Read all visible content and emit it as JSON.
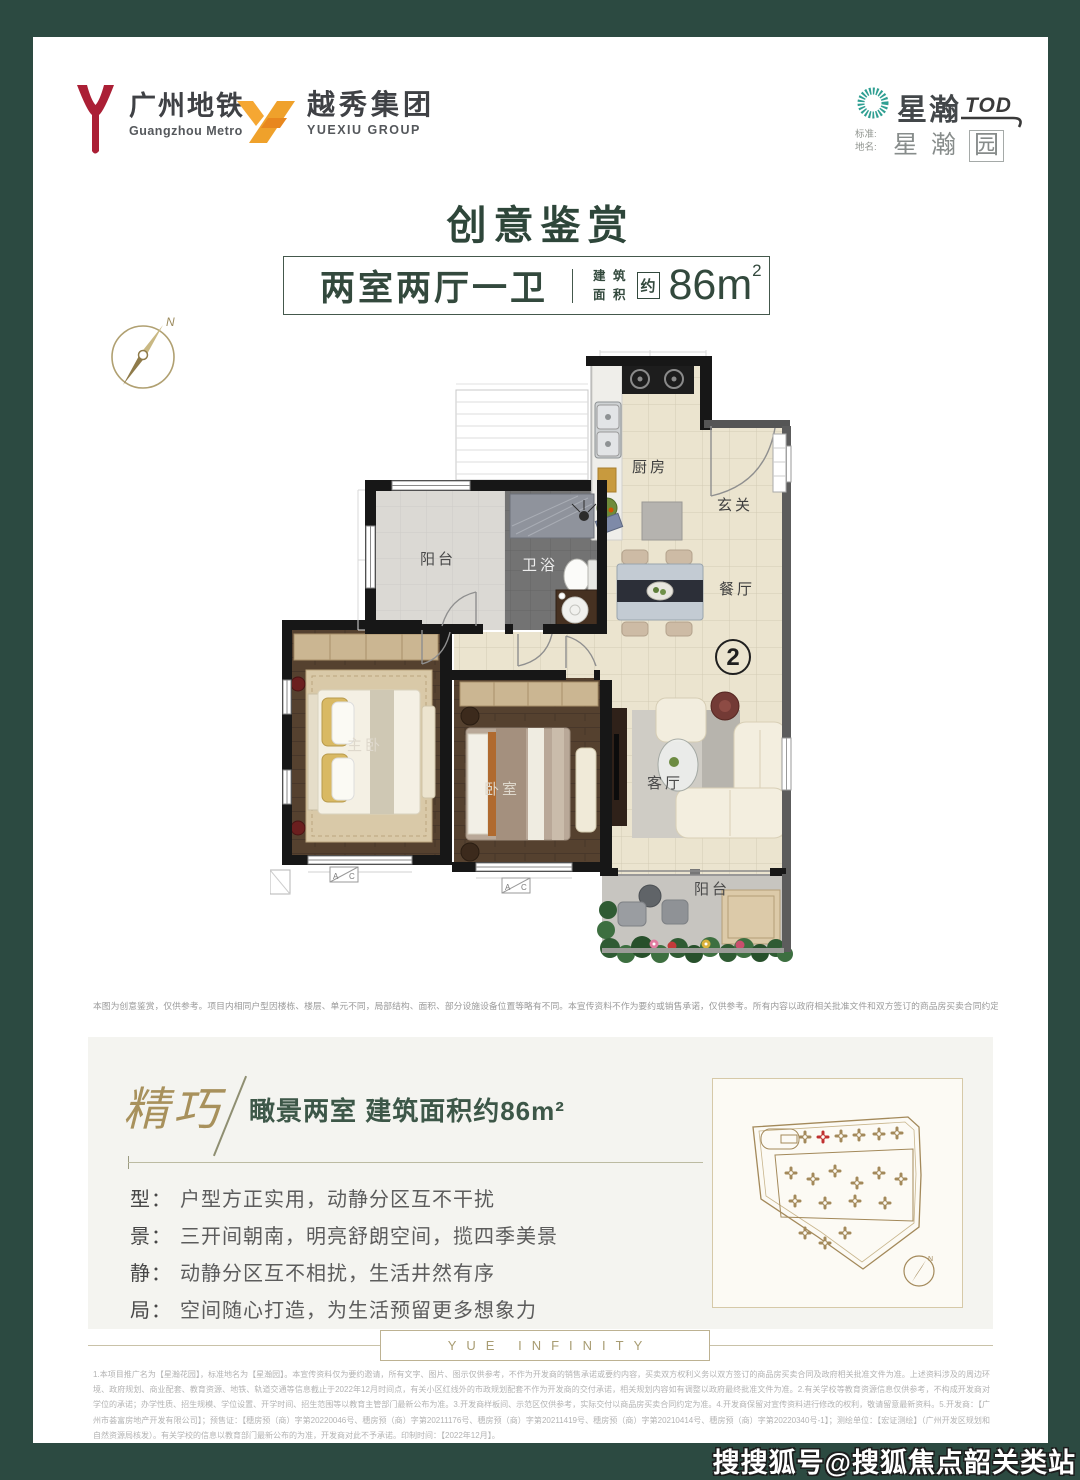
{
  "page": {
    "bg": "#2c4a41",
    "card_bg": "#ffffff",
    "accent_green": "#2e463a",
    "accent_gold": "#a8915c"
  },
  "header": {
    "gzmetro": {
      "name_cn": "广州地铁",
      "name_en": "Guangzhou Metro",
      "logo_color": "#ab1f35"
    },
    "yuexiu": {
      "name_cn": "越秀集团",
      "name_en": "YUEXIU GROUP",
      "logo_color": "#f09f2c"
    },
    "brand": {
      "name": "星瀚",
      "tod": "TOD",
      "std_label_1": "标准:",
      "std_label_2": "地名:",
      "place_1": "星",
      "place_2": "瀚",
      "place_3": "园",
      "icon_color": "#2f9f92"
    }
  },
  "title": "创意鉴赏",
  "spec": {
    "layout": "两室两厅一卫",
    "area_l1": "建 筑",
    "area_l2": "面 积",
    "approx": "约",
    "area_value": "86m",
    "area_sup": "2"
  },
  "compass": {
    "north": "N"
  },
  "floorplan": {
    "unit_number": "2",
    "rooms": [
      {
        "label": "厨房"
      },
      {
        "label": "玄关"
      },
      {
        "label": "阳台"
      },
      {
        "label": "卫浴"
      },
      {
        "label": "餐厅"
      },
      {
        "label": "主卧"
      },
      {
        "label": "卧室"
      },
      {
        "label": "客厅"
      },
      {
        "label": "阳台"
      }
    ],
    "window_marks": {
      "a": "A",
      "c": "C"
    }
  },
  "disclaimer": "本图为创意鉴赏，仅供参考。项目内相同户型因楼栋、楼层、单元不同，局部结构、面积、部分设施设备位置等略有不同。本宣传资料不作为要约或销售承诺，仅供参考。所有内容以政府相关批准文件和双方签订的商品房买卖合同约定内容为准。",
  "feature": {
    "accent_word": "精巧",
    "headline": "瞰景两室 建筑面积约86m²",
    "points": [
      {
        "key": "型：",
        "text": "户型方正实用，动静分区互不干扰"
      },
      {
        "key": "景：",
        "text": "三开间朝南，明亮舒朗空间，揽四季美景"
      },
      {
        "key": "静：",
        "text": "动静分区互不相扰，生活井然有序"
      },
      {
        "key": "局：",
        "text": "空间随心打造，为生活预留更多想象力"
      }
    ]
  },
  "siteplan": {
    "north": "N"
  },
  "footer": {
    "brand_en": "YUE INFINITY",
    "fine_print": "1.本项目推广名为【星瀚花园】，标准地名为【星瀚园】。本宣传资料仅为要约邀请，所有文字、图片、图示仅供参考，不作为开发商的销售承诺或要约内容，买卖双方权利义务以双方签订的商品房买卖合同及政府相关批准文件为准。上述资料涉及的周边环境、政府规划、商业配套、教育资源、地铁、轨道交通等信息截止于2022年12月时间点，有关小区红线外的市政规划配套不作为开发商的交付承诺，相关规划内容如有调整以政府最终批准文件为准。2.有关学校等教育资源信息仅供参考，不构成开发商对学位的承诺；办学性质、招生规模、学位设置、开学时间、招生范围等以教育主管部门最新公布为准。3.开发商样板间、示范区仅供参考，实际交付以商品房买卖合同约定为准。4.开发商保留对宣传资料进行修改的权利，敬请留意最新资料。5.开发商：【广州市荟富房地产开发有限公司】；预售证：【穗房预（商）字第20220046号、穗房预（商）字第20211176号、穗房预（商）字第20211419号、穗房预（商）字第20210414号、穗房预（商）字第20220340号-1】；测绘单位：【宏证测绘】（广州开发区规划和自然资源局核发）。有关学校的信息以教育部门最新公布的为准，开发商对此不予承诺。印制时间：【2022年12月】。"
  },
  "watermark": "搜搜狐号@搜狐焦点韶关类站"
}
